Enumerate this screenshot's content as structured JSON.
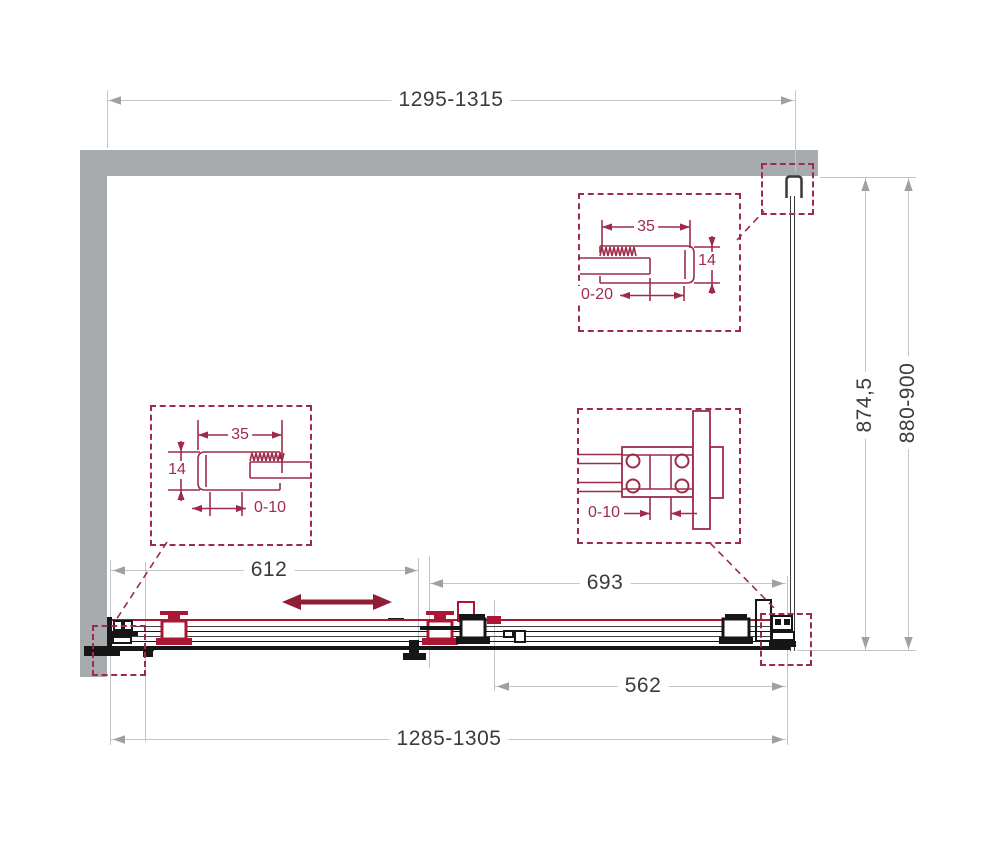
{
  "dimensions": {
    "top_width": "1295-1315",
    "height_glass": "874,5",
    "height_total": "880-900",
    "door_travel_width": "612",
    "fixed_section_width": "693",
    "glass_panel_width": "562",
    "bottom_width": "1285-1305"
  },
  "details": {
    "top_wall_profile": {
      "profile_width": "35",
      "profile_depth": "14",
      "adjustment_range": "0-20"
    },
    "left_wall_profile": {
      "profile_width": "35",
      "profile_depth": "14",
      "adjustment_range": "0-10"
    },
    "bottom_bracket": {
      "adjustment_range": "0-10"
    }
  },
  "colors": {
    "wall": "#A8ABAD",
    "dimension_line": "#C3C5C7",
    "dimension_text": "#393C3E",
    "detail_accent": "#9D2C4B",
    "mechanism_red": "#AC1635",
    "mechanism_black": "#161616",
    "slide_arrow": "#8E1D35"
  }
}
